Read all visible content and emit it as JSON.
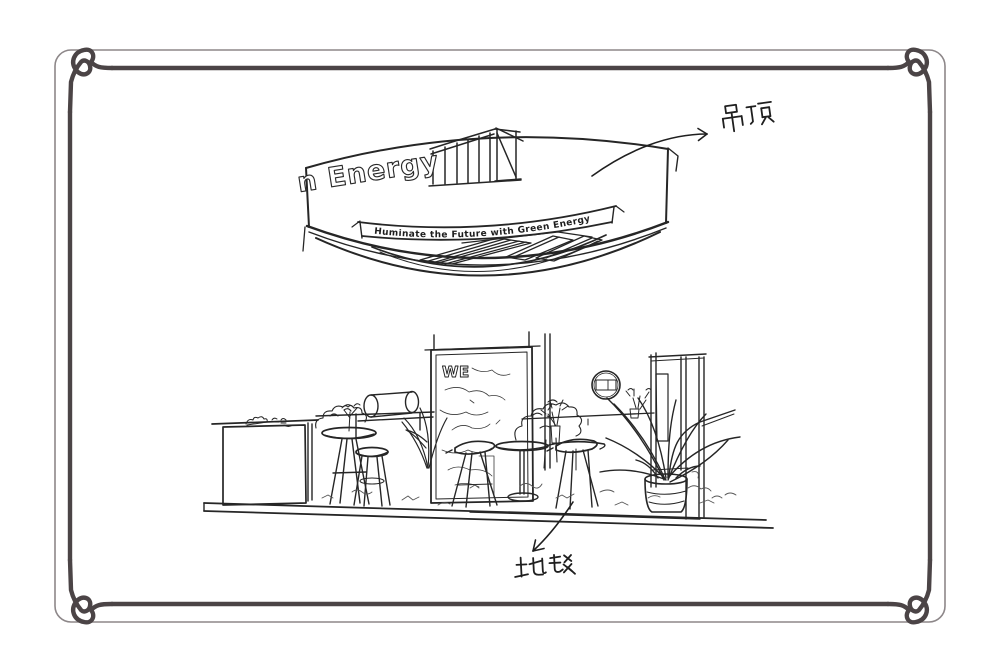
{
  "colors": {
    "background": "#ffffff",
    "ink": "#262626",
    "ink_light": "#555555",
    "frame_inner": "#4b4446",
    "frame_outer": "#8d8789"
  },
  "ceiling": {
    "brand_text": "n Energy",
    "slogan": "Huminate the Future with Green Energy"
  },
  "backdrop": {
    "sign_text": "WE"
  },
  "annotations": {
    "ceiling": {
      "text": "吊顶"
    },
    "carpet": {
      "text": "地毯"
    }
  },
  "icons": {
    "ceiling_logo": "hatched-stripes-logo",
    "ceiling_arrow": "curved-arrow",
    "carpet_arrow": "straight-arrow",
    "frame_corner": "loop-ornament"
  }
}
